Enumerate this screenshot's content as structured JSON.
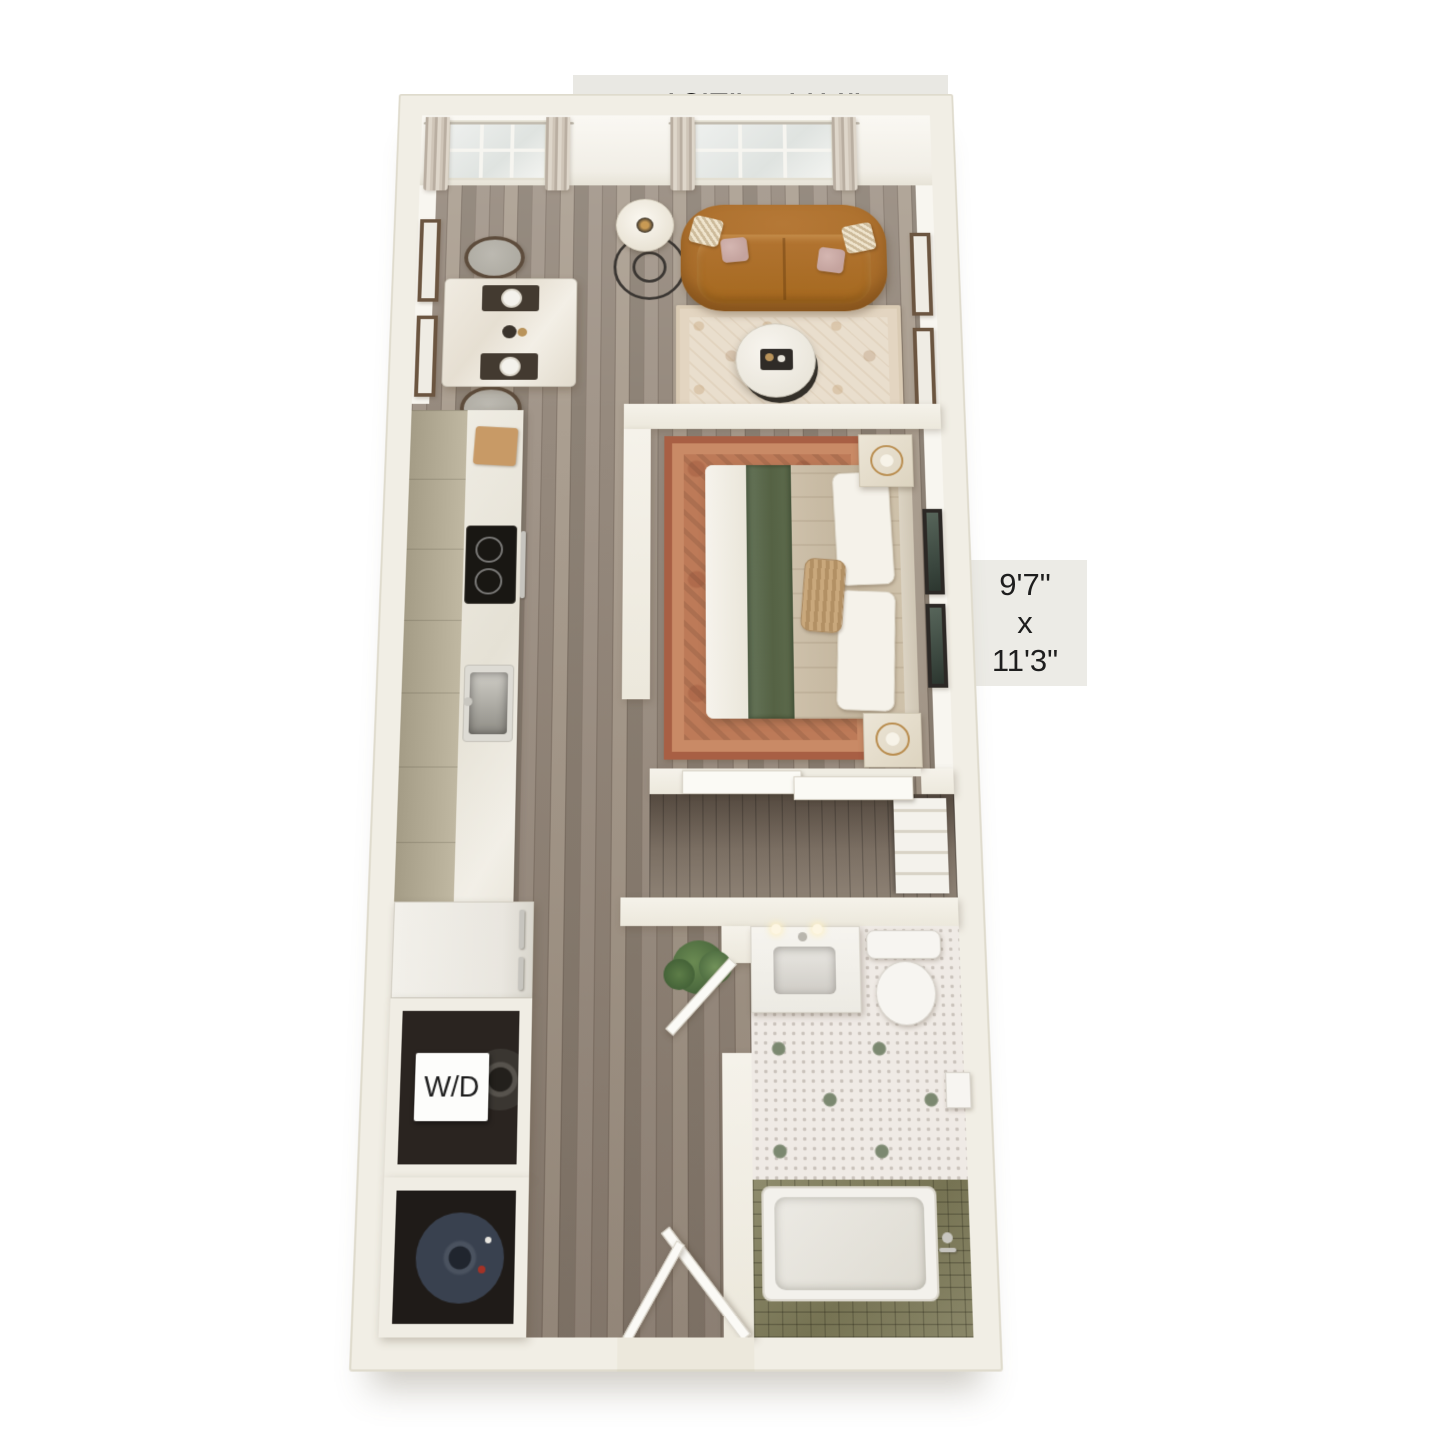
{
  "page": {
    "background": "#ffffff"
  },
  "floorplan": {
    "type": "3d-apartment-floor-plan",
    "labels": {
      "living_room_dimensions": "13'7\" x 11'4\"",
      "bedroom_dimensions": {
        "width": "9'7\"",
        "separator": "x",
        "length": "11'3\""
      },
      "washer_dryer": "W/D"
    },
    "rooms": [
      "living-room",
      "dining-area",
      "kitchen",
      "bedroom",
      "closet",
      "bathroom",
      "hallway",
      "washer-dryer-closet",
      "utility-closet"
    ],
    "colors": {
      "outer_wall": "#f1eee5",
      "label_tab_background": "#e9e8e3",
      "label_text": "#1e1e1e",
      "wood_floor": "#9b9083",
      "sofa": "#a96d2a",
      "living_rug": "#e9decd",
      "bedroom_rug": "#bd7a58",
      "bed_throw_green": "#5d6b4d",
      "bathroom_tile_accent": "#7b8870",
      "shower_tile_olive": "#8a8769",
      "water_heater_navy": "#39414f"
    }
  }
}
